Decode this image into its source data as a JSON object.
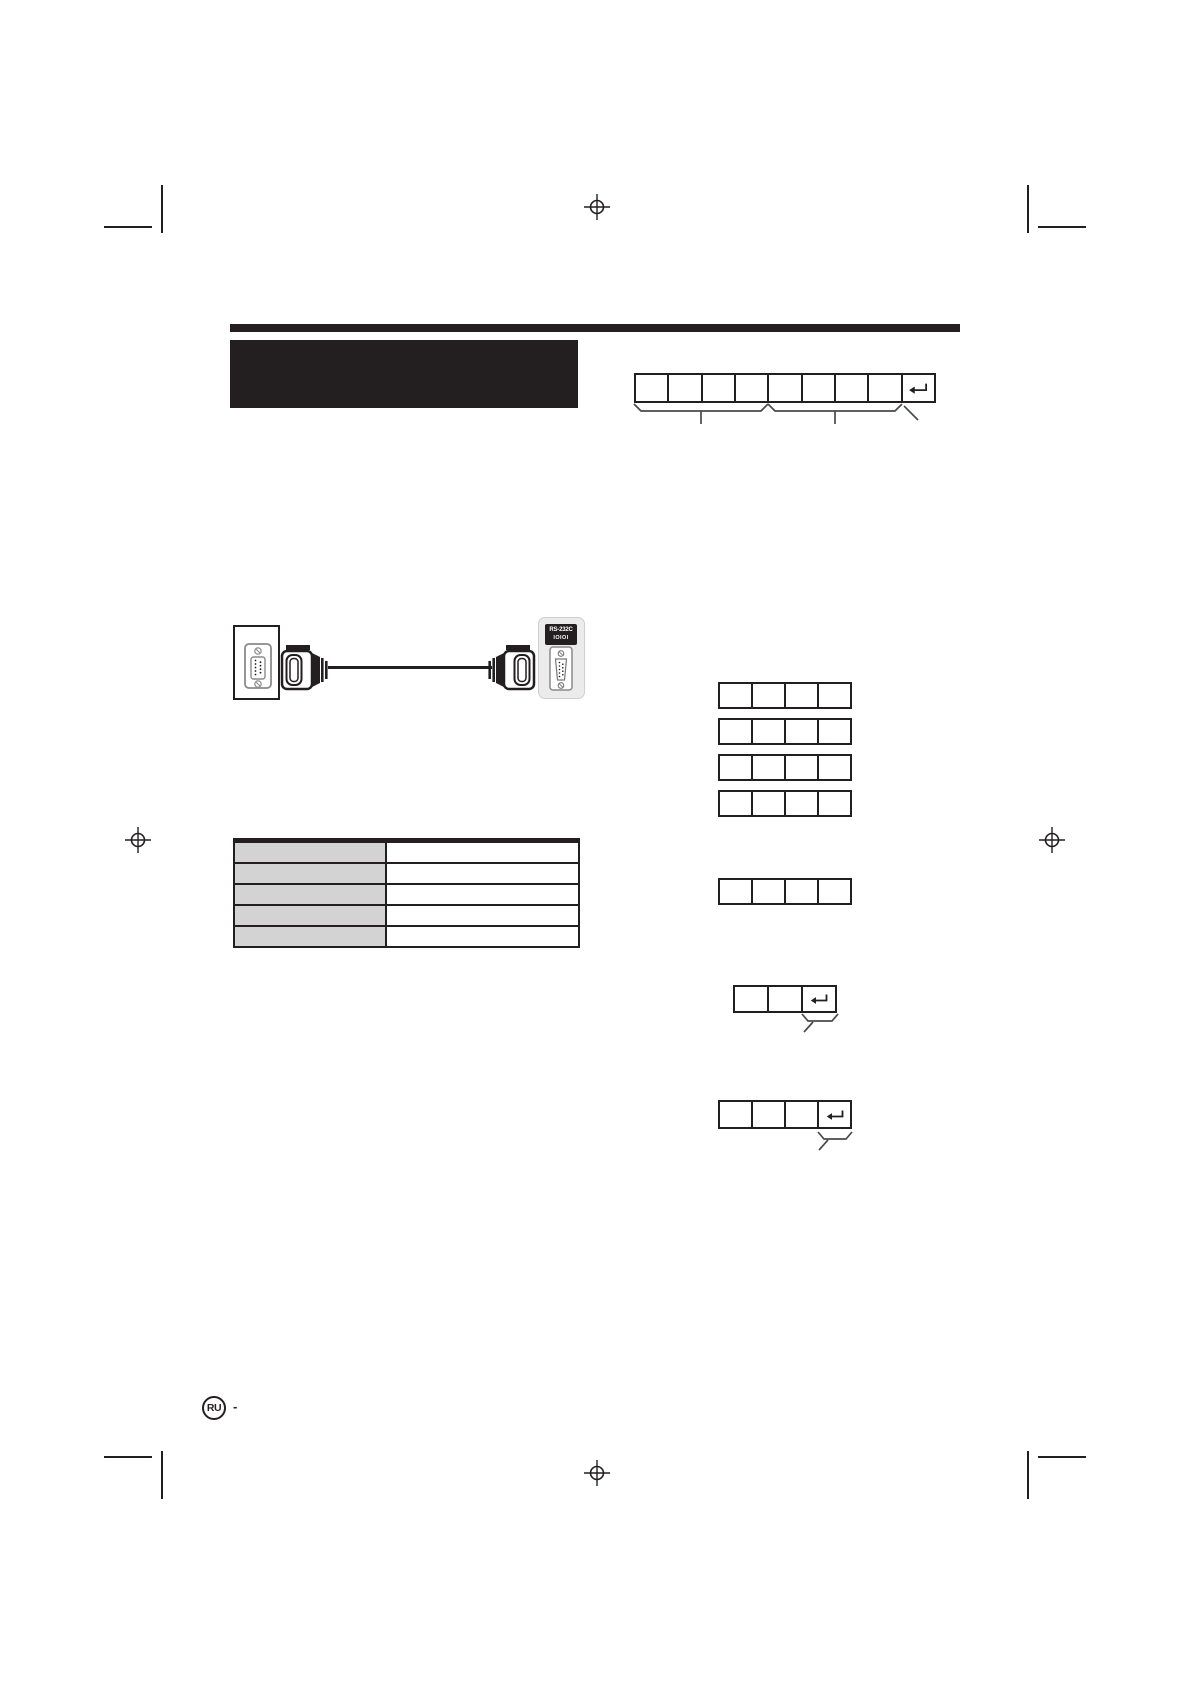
{
  "port_panel": {
    "line1": "RS-232C",
    "line2": "IOIOI"
  },
  "footer": {
    "language_badge": "RU",
    "separator": "-"
  },
  "symbols": {
    "return_key": "↵"
  },
  "colors": {
    "ink": "#231f20",
    "table_label_fill": "#d3d3d3",
    "panel_fill": "#ebebeb"
  },
  "figures": {
    "command_format_grid": {
      "cells": 9,
      "has_return_cell": true
    },
    "parameter_grid": {
      "cells": 4
    },
    "parameter_grid_rows": 4,
    "single_parameter_grid": {
      "cells": 4
    },
    "response_grid_short": {
      "cells": 3,
      "has_return_cell": true
    },
    "response_grid_long": {
      "cells": 4,
      "has_return_cell": true
    },
    "pin_table": {
      "rows": 5,
      "columns": 2
    }
  }
}
